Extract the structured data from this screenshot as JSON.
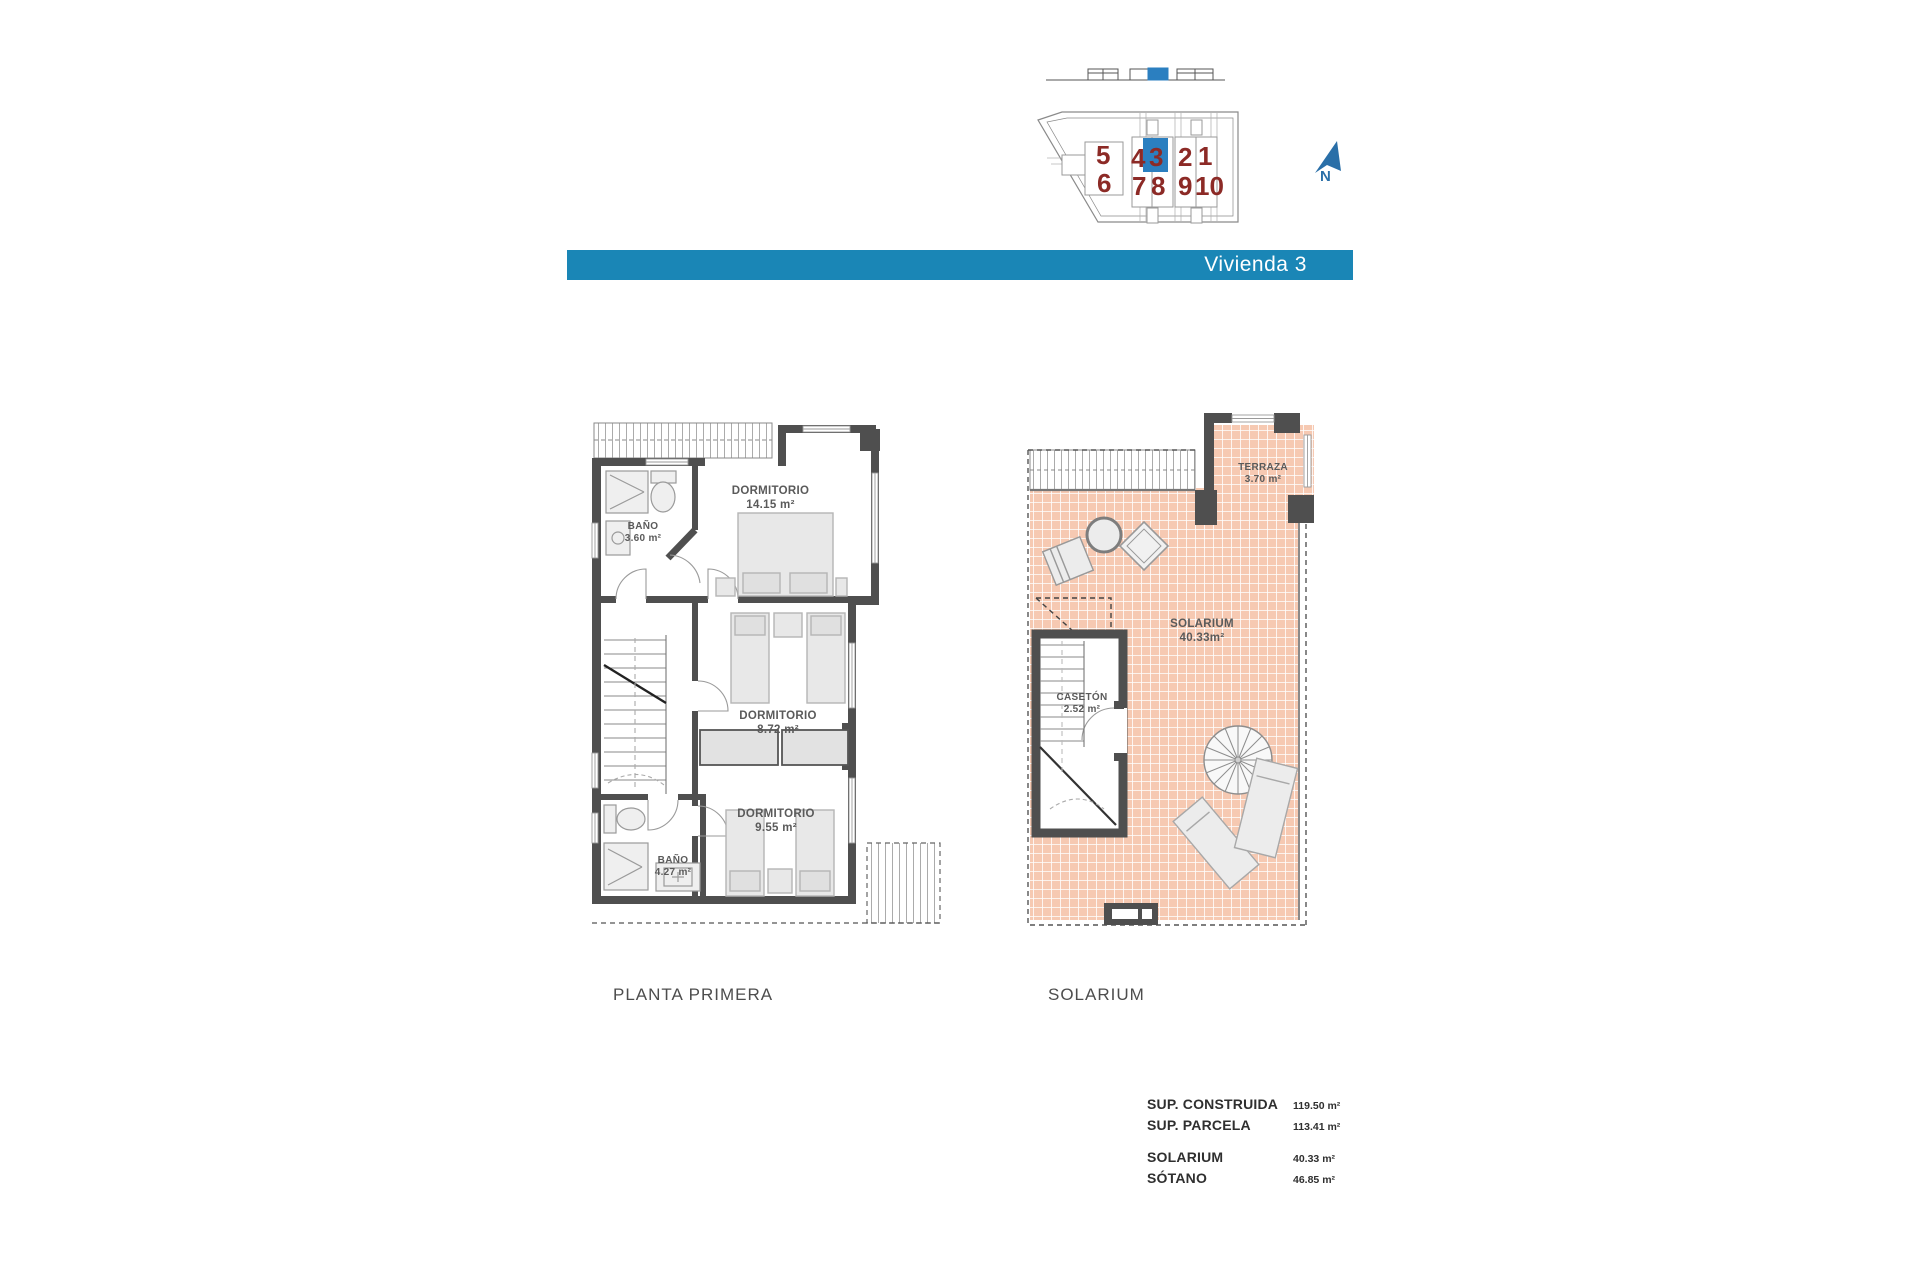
{
  "banner": {
    "title": "Vivienda 3",
    "color": "#1a86b6"
  },
  "sitemap": {
    "units": [
      {
        "label": "5"
      },
      {
        "label": "6"
      },
      {
        "label": "4"
      },
      {
        "label": "3"
      },
      {
        "label": "7"
      },
      {
        "label": "8"
      },
      {
        "label": "2"
      },
      {
        "label": "1"
      },
      {
        "label": "9"
      },
      {
        "label": "10"
      }
    ],
    "highlighted_unit": "3",
    "north_label": "N"
  },
  "plans": {
    "planta_primera": {
      "caption": "PLANTA PRIMERA",
      "rooms": [
        {
          "name": "BAÑO",
          "area": "3.60 m²"
        },
        {
          "name": "DORMITORIO",
          "area": "14.15 m²"
        },
        {
          "name": "DORMITORIO",
          "area": "8.72 m²"
        },
        {
          "name": "DORMITORIO",
          "area": "9.55 m²"
        },
        {
          "name": "BAÑO",
          "area": "4.27 m²"
        }
      ]
    },
    "solarium": {
      "caption": "SOLARIUM",
      "rooms": [
        {
          "name": "TERRAZA",
          "area": "3.70 m²"
        },
        {
          "name": "SOLARIUM",
          "area": "40.33m²"
        },
        {
          "name": "CASETÓN",
          "area": "2.52 m²"
        }
      ]
    }
  },
  "summary": {
    "rows": [
      {
        "label": "SUP. CONSTRUIDA",
        "value": "119.50 m²"
      },
      {
        "label": "SUP. PARCELA",
        "value": "113.41 m²"
      },
      {
        "label": "SOLARIUM",
        "value": "40.33 m²"
      },
      {
        "label": "SÓTANO",
        "value": "46.85 m²"
      }
    ]
  },
  "colors": {
    "banner_blue": "#1a86b6",
    "highlight_blue": "#2b7fc0",
    "unit_number_red": "#8c2a26",
    "tile_pink": "#f6c9b2",
    "wall_gray": "#4f4f4f",
    "north_blue": "#2a6fa8"
  }
}
